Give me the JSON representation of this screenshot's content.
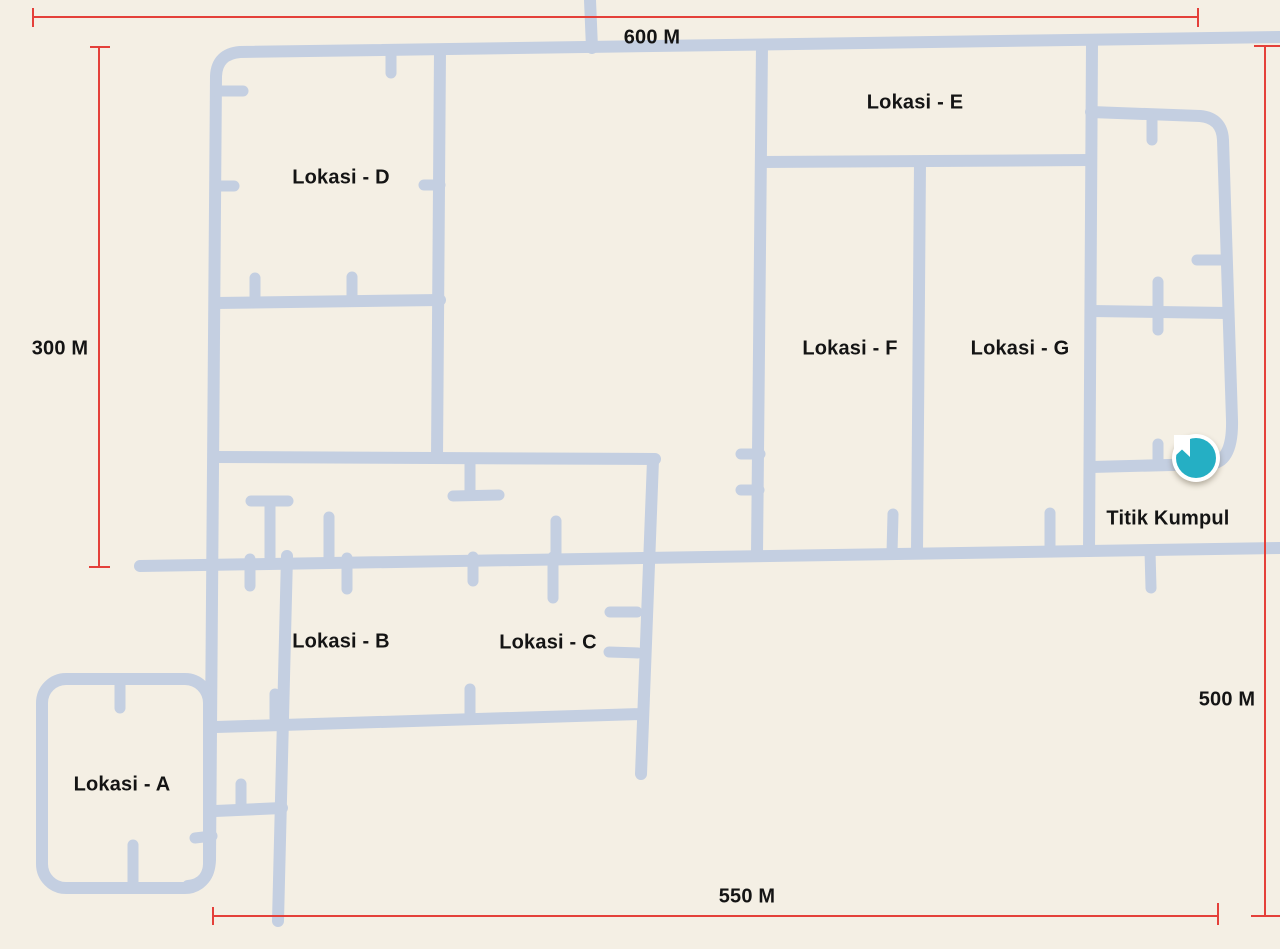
{
  "map": {
    "title": "Site map with locations and distances",
    "locations": [
      {
        "id": "A",
        "label": "Lokasi - A"
      },
      {
        "id": "B",
        "label": "Lokasi - B"
      },
      {
        "id": "C",
        "label": "Lokasi - C"
      },
      {
        "id": "D",
        "label": "Lokasi - D"
      },
      {
        "id": "E",
        "label": "Lokasi - E"
      },
      {
        "id": "F",
        "label": "Lokasi - F"
      },
      {
        "id": "G",
        "label": "Lokasi - G"
      }
    ],
    "meeting_point": {
      "label": "Titik Kumpul",
      "icon": "bookmark-icon"
    },
    "measurements": [
      {
        "id": "top",
        "label": "600 M"
      },
      {
        "id": "left",
        "label": "300 M"
      },
      {
        "id": "right",
        "label": "500 M"
      },
      {
        "id": "bottom",
        "label": "550 M"
      }
    ],
    "colors": {
      "background": "#f4efe4",
      "road": "#c4cfe1",
      "dimension": "#e4403a",
      "marker": "#25afc4",
      "marker_ring": "#ffffff",
      "text": "#141414"
    }
  }
}
